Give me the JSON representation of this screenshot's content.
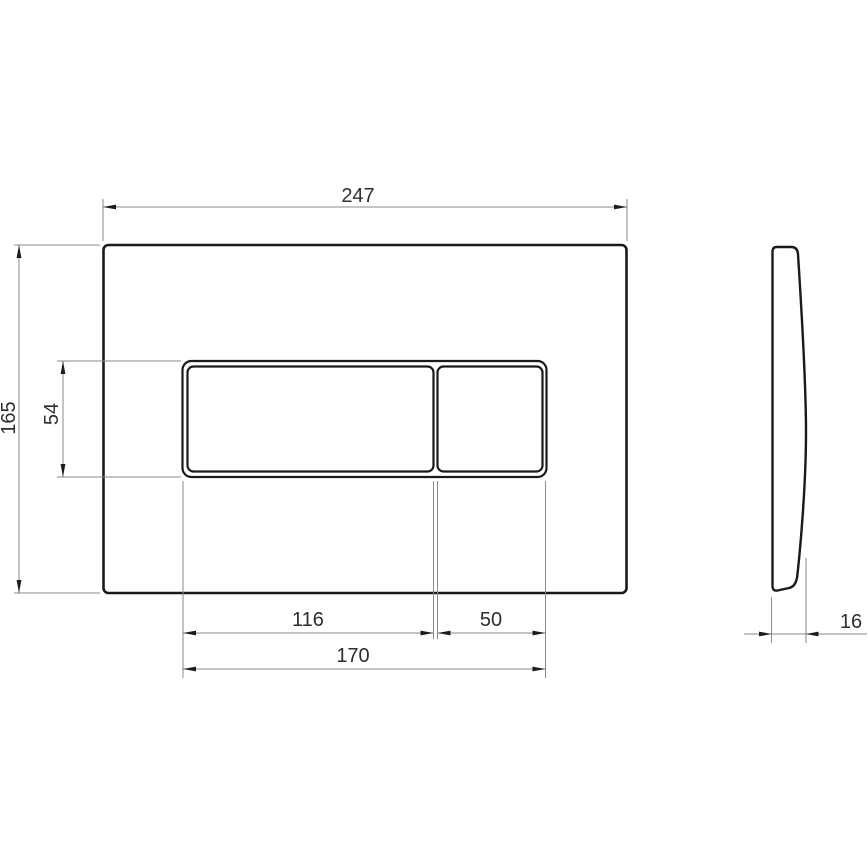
{
  "drawing": {
    "kind": "technical-drawing",
    "subject": "flush-plate-with-two-buttons",
    "views": {
      "front": "front-view",
      "side": "side-view"
    }
  },
  "dimensions": {
    "plate_width": "247",
    "plate_height": "165",
    "buttons_height": "54",
    "large_button_width": "116",
    "small_button_width": "50",
    "buttons_overall_width": "170",
    "plate_thickness": "16"
  },
  "colors": {
    "outline": "#1a1a1a",
    "dimension_line": "#8a8a8a",
    "dimension_text": "#2e2e2e",
    "background": "#ffffff"
  }
}
